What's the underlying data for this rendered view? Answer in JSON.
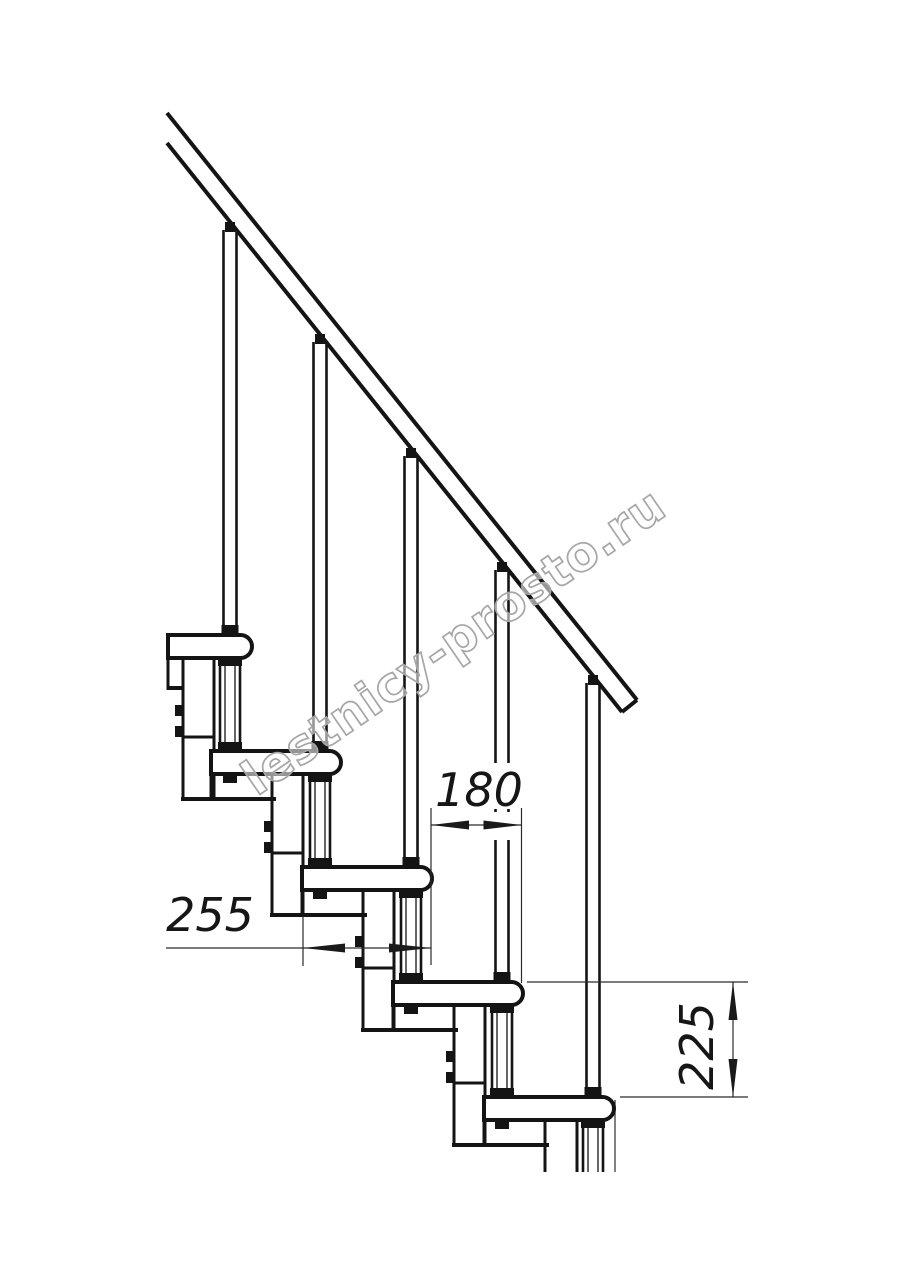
{
  "figure": {
    "kind": "technical line drawing",
    "subject": "modular staircase side elevation with handrail, balusters, treads and support modules",
    "background": "#ffffff",
    "line_color": "#141414"
  },
  "dimension_labels": {
    "run": "180",
    "depth": "255",
    "rise": "225"
  },
  "watermark": {
    "text": "lestnicy-prosto.ru",
    "color": "#a6a6a6"
  },
  "structure": {
    "treads": 5,
    "balusters": 5,
    "handrail": 1,
    "support_modules": 5
  }
}
